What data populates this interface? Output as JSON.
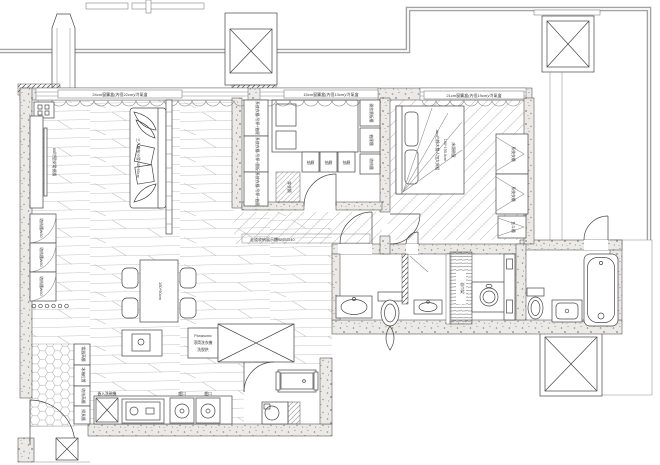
{
  "annotations": {
    "curtain_left": "24cm窗簾盒(內徑22cm)/冷氣盒",
    "curtain_mid": "15cm窗簾盒(內徑13cm)/冷氣盒",
    "curtain_right": "21cm窗簾盒(內徑19cm)/冷氣盒",
    "corridor_note": "走道收納展示櫃W40/D40"
  },
  "living": {
    "tv_label": "65吋壁掛電視牆",
    "sofa_label": "三人座布沙發240*95cm",
    "side_cabinets": [
      "收納櫃W60",
      "收納櫃W60",
      "收納櫃W60"
    ]
  },
  "dining": {
    "table_label": "150*90cm"
  },
  "closet": {
    "left_cabinets": [
      "系統衣櫃/吊桿+抽屜",
      "系統衣櫃/吊桿+層板",
      "系統衣櫃/吊桿+抽屜"
    ],
    "drawers": [
      "抽屜",
      "抽屜",
      "抽屜"
    ],
    "right_cabinets": [
      "開放層板櫃",
      "抽屜櫃",
      "收納櫃"
    ],
    "mirror_label": "穿衣鏡"
  },
  "bedroom": {
    "bed_lines": [
      "Abs白橡木雙人加大床組",
      "190*195.5cm",
      "床頭朝窗"
    ],
    "wardrobes": [
      "系統衣櫃",
      "系統衣櫃"
    ],
    "dresser_label": "五斗櫃"
  },
  "kitchen": {
    "cabinets": [
      "電器高櫃",
      "冰箱位置",
      "收納高櫃",
      "掃具櫃"
    ],
    "dishwasher_label": "嵌入洗碗機",
    "hob_labels": [
      "爐口",
      "爐口"
    ],
    "laundry_lines": [
      "Panasonic",
      "滾筒洗衣機",
      "洗脫烘"
    ]
  },
  "bath": {
    "linen_label": "浴巾架"
  }
}
